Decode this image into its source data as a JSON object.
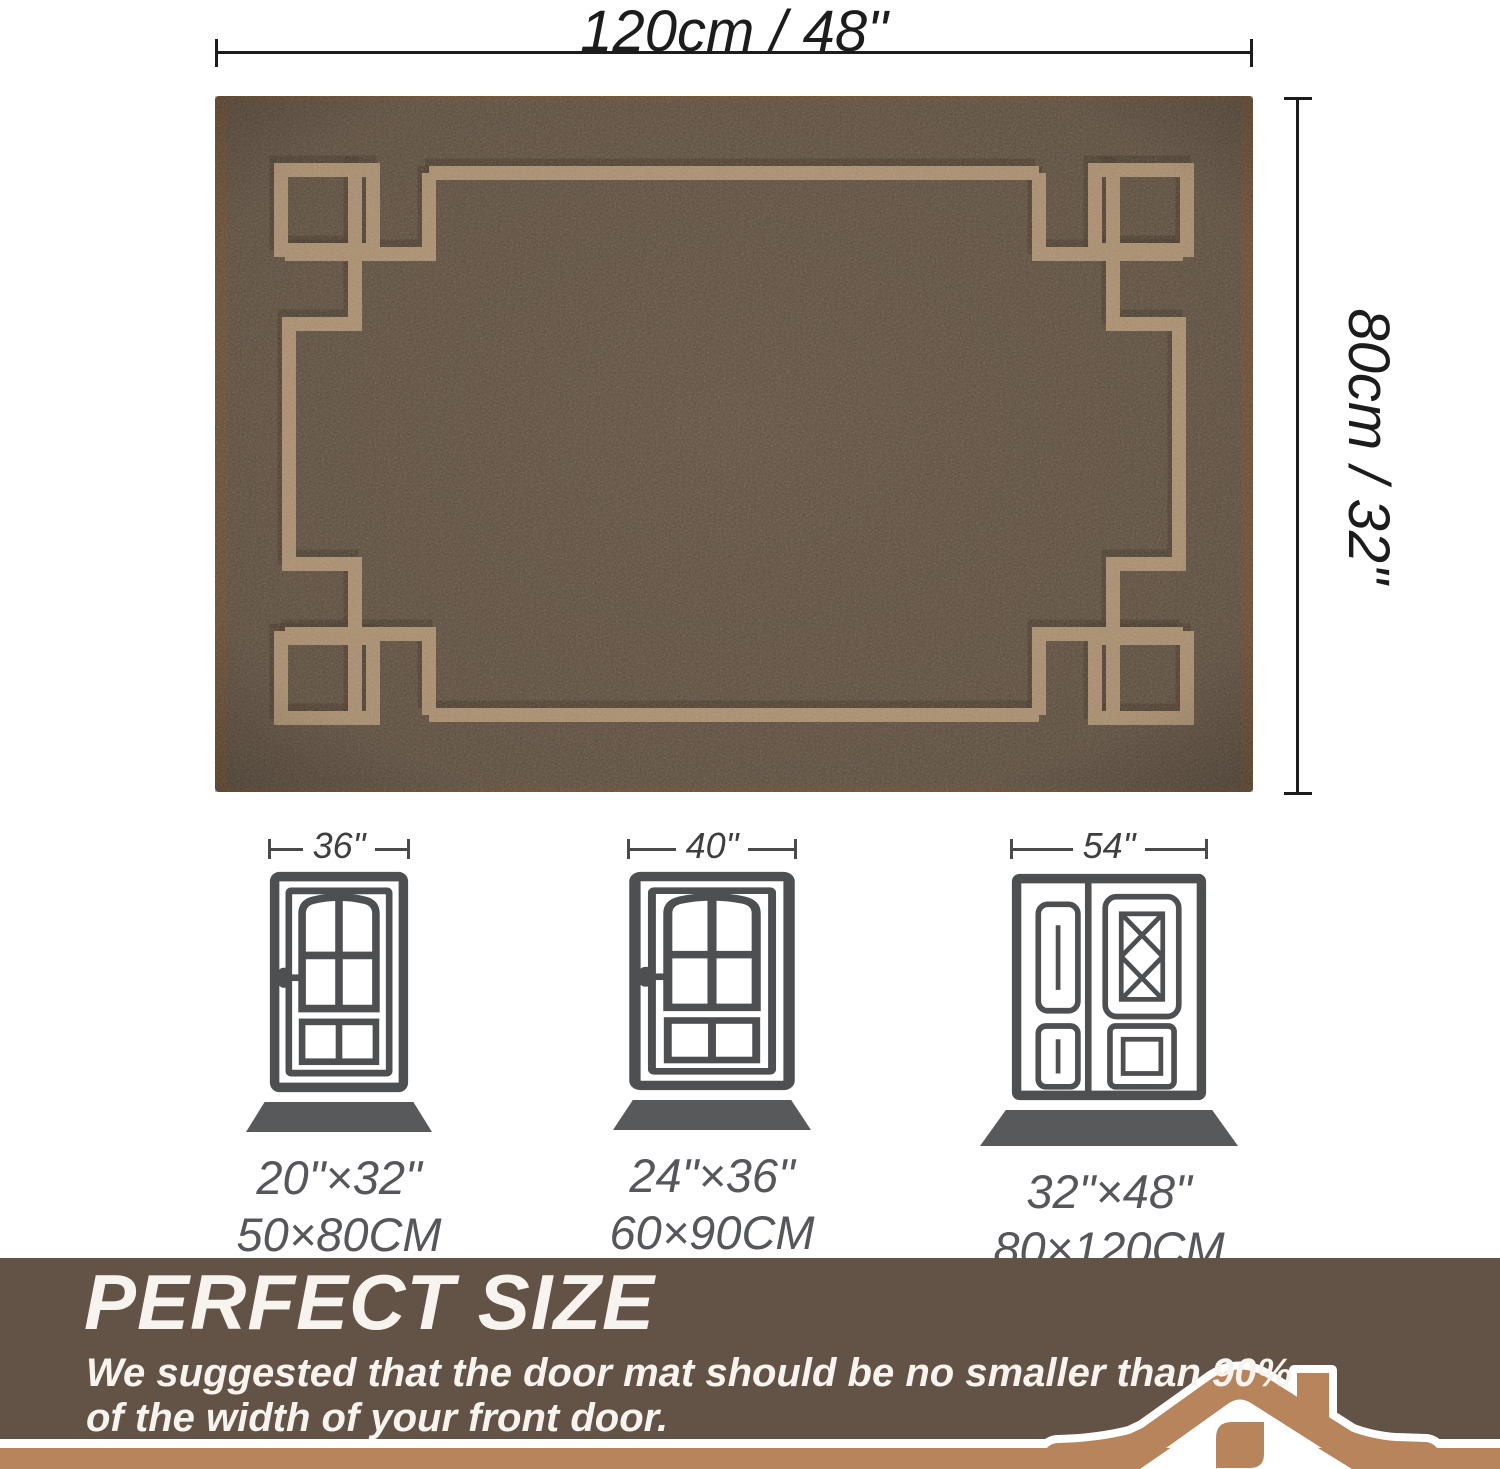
{
  "dimensions": {
    "width_label": "120cm / 48\"",
    "height_label": "80cm / 32\""
  },
  "doors": [
    {
      "type": "single-door",
      "width_label": "36\"",
      "mat_inches": "20\"×32\"",
      "mat_cm": "50×80CM"
    },
    {
      "type": "single-door",
      "width_label": "40\"",
      "mat_inches": "24\"×36\"",
      "mat_cm": "60×90CM"
    },
    {
      "type": "double-door",
      "width_label": "54\"",
      "mat_inches": "32\"×48\"",
      "mat_cm": "80×120CM"
    }
  ],
  "banner": {
    "title": "PERFECT SIZE",
    "subtitle_line1": "We suggested that the door mat should be no smaller than 90%",
    "subtitle_line2": "of the width of your front door."
  },
  "colors": {
    "mat-base": "#635241",
    "mat-pattern": "#b29573",
    "mat-edge": "#6e5236",
    "door-gray": "#4e4f51",
    "trap-gray": "#58595b",
    "label-gray": "#56575a",
    "dim-dark": "#1c1c1c",
    "banner-bg": "#635346",
    "accent-tan": "#b8845c",
    "banner-text": "#f7f3ee"
  }
}
